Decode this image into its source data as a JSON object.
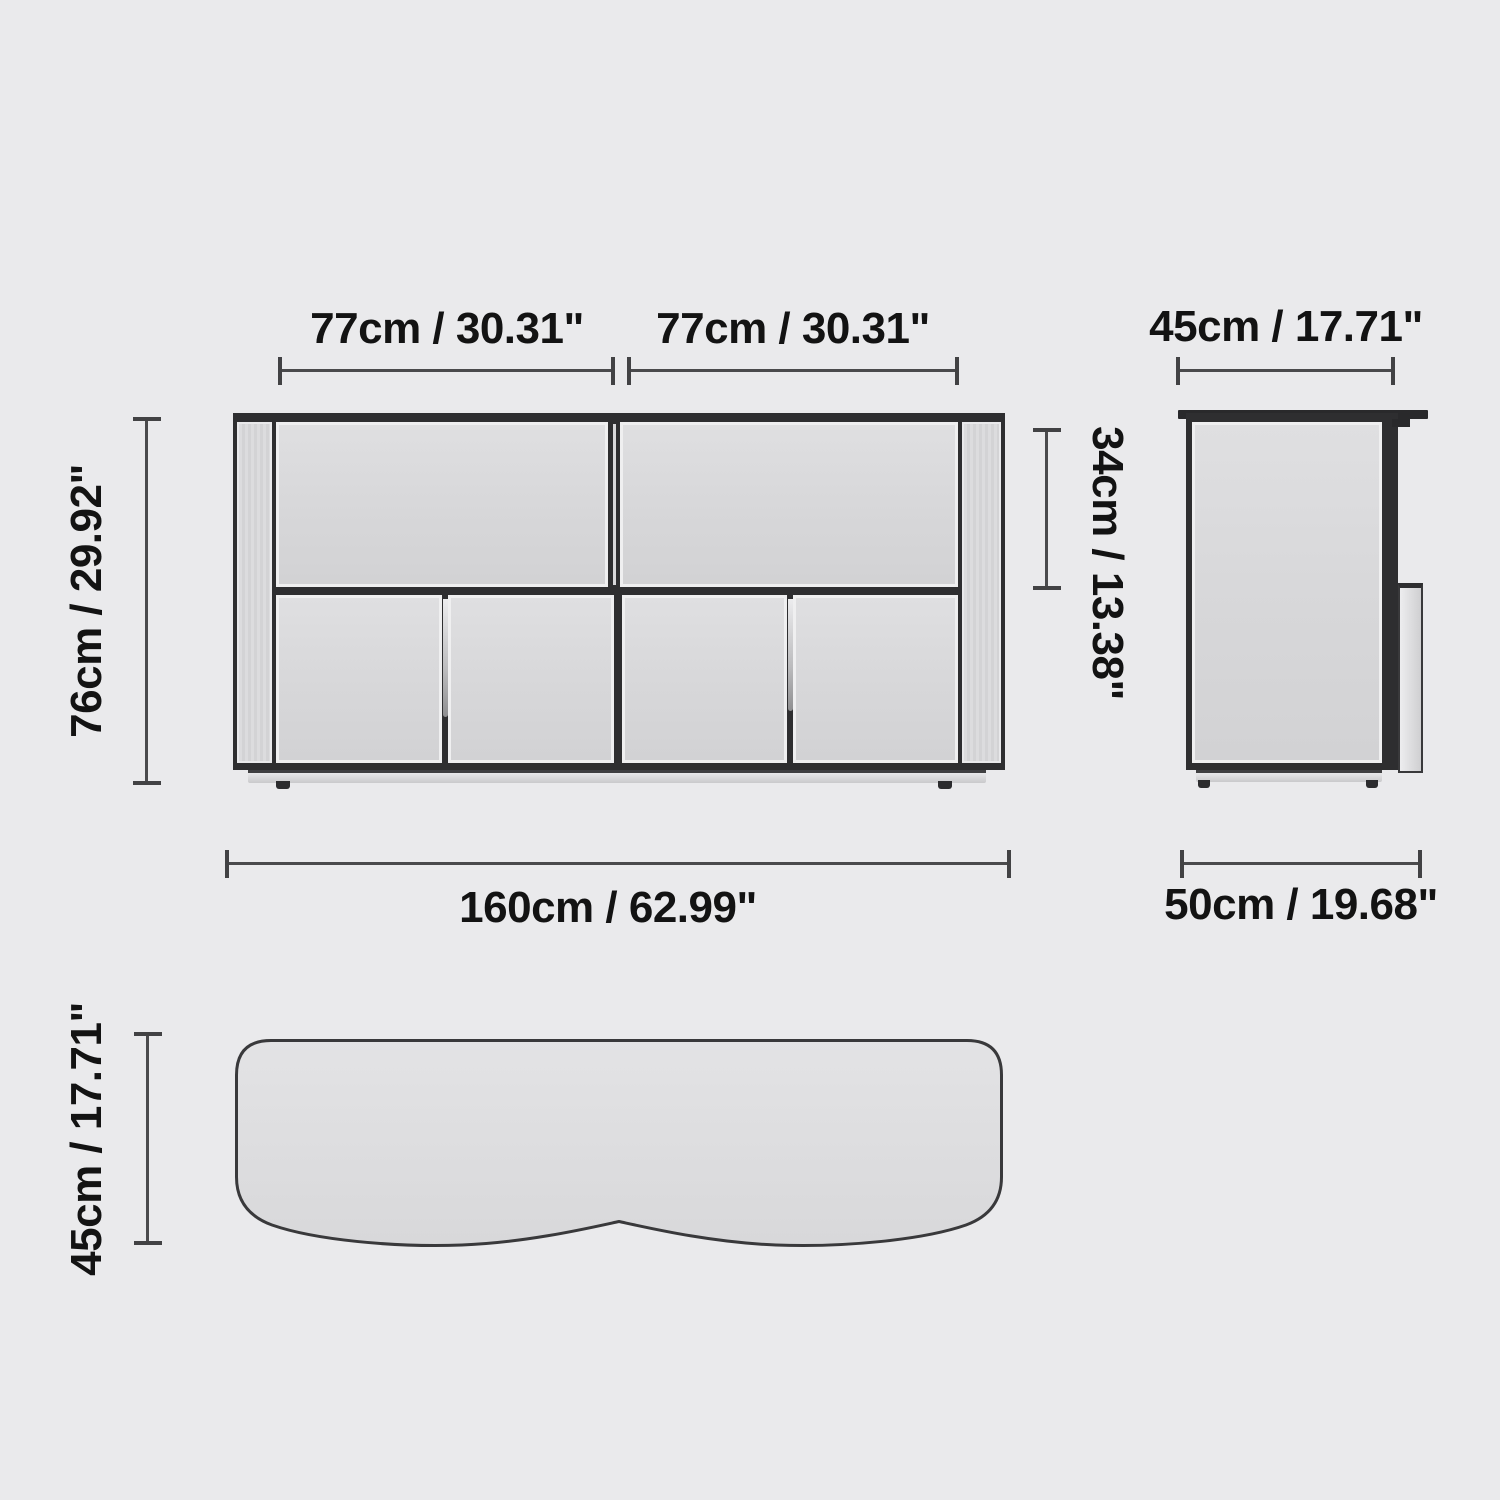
{
  "diagram": {
    "front_view": {
      "width_left": "77cm / 30.31\"",
      "width_right": "77cm / 30.31\"",
      "height": "76cm / 29.92\"",
      "drawer_height": "34cm / 13.38\"",
      "total_width": "160cm / 62.99\""
    },
    "side_view": {
      "top_depth": "45cm / 17.71\"",
      "base_depth": "50cm / 19.68\""
    },
    "top_view": {
      "depth": "45cm / 17.71\""
    }
  },
  "colors": {
    "background": "#eaeaec",
    "panel_fill": "#d6d6d8",
    "outline": "#2e2e30",
    "dimension_line": "#4a4a4c",
    "label_text": "#131313"
  }
}
